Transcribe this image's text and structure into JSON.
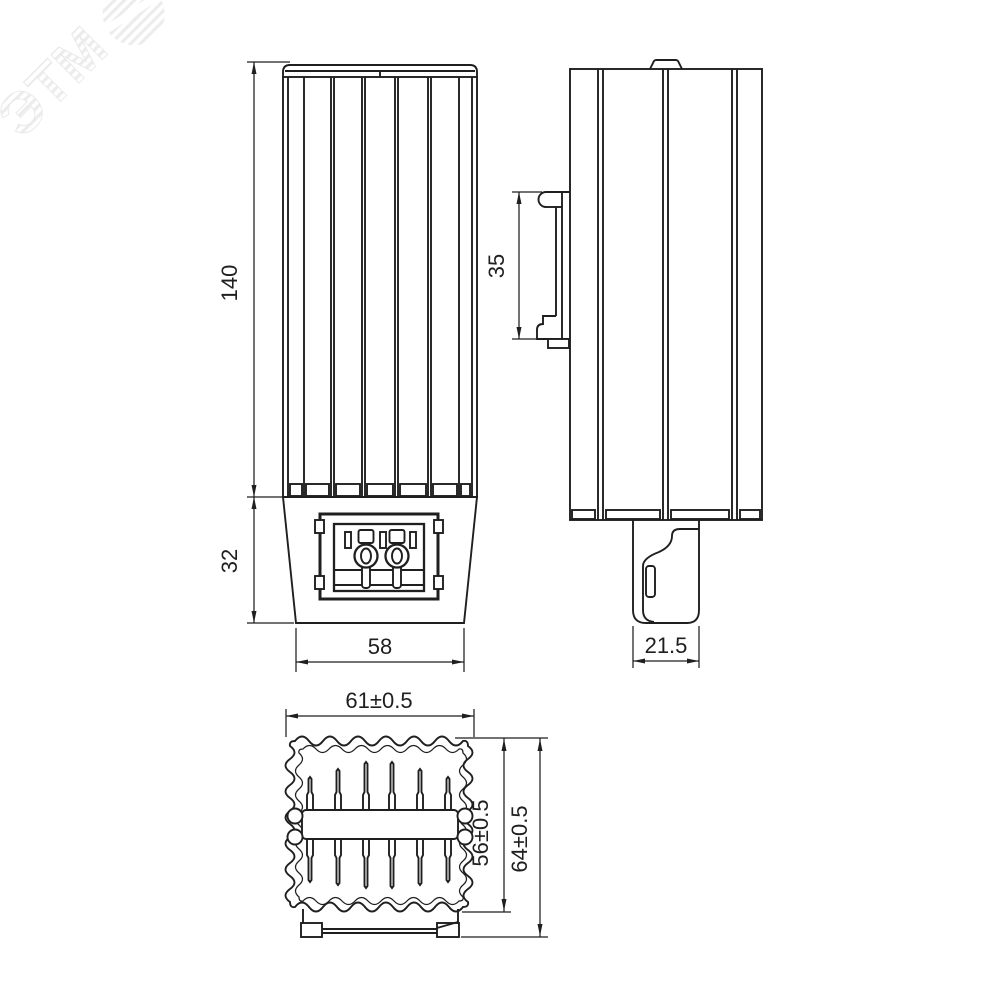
{
  "watermark": {
    "brand": "ЭТМ"
  },
  "views": {
    "front": {
      "dim_height": "140",
      "dim_base_height": "32",
      "dim_width": "58"
    },
    "side": {
      "dim_din_rail": "35",
      "dim_clip_depth": "21.5"
    },
    "bottom": {
      "dim_outer_width": "61±0.5",
      "dim_fin_height": "56±0.5",
      "dim_total_height": "64±0.5"
    }
  },
  "colors": {
    "line": "#1f1f1f",
    "background": "#ffffff",
    "watermark": "#ececec"
  }
}
